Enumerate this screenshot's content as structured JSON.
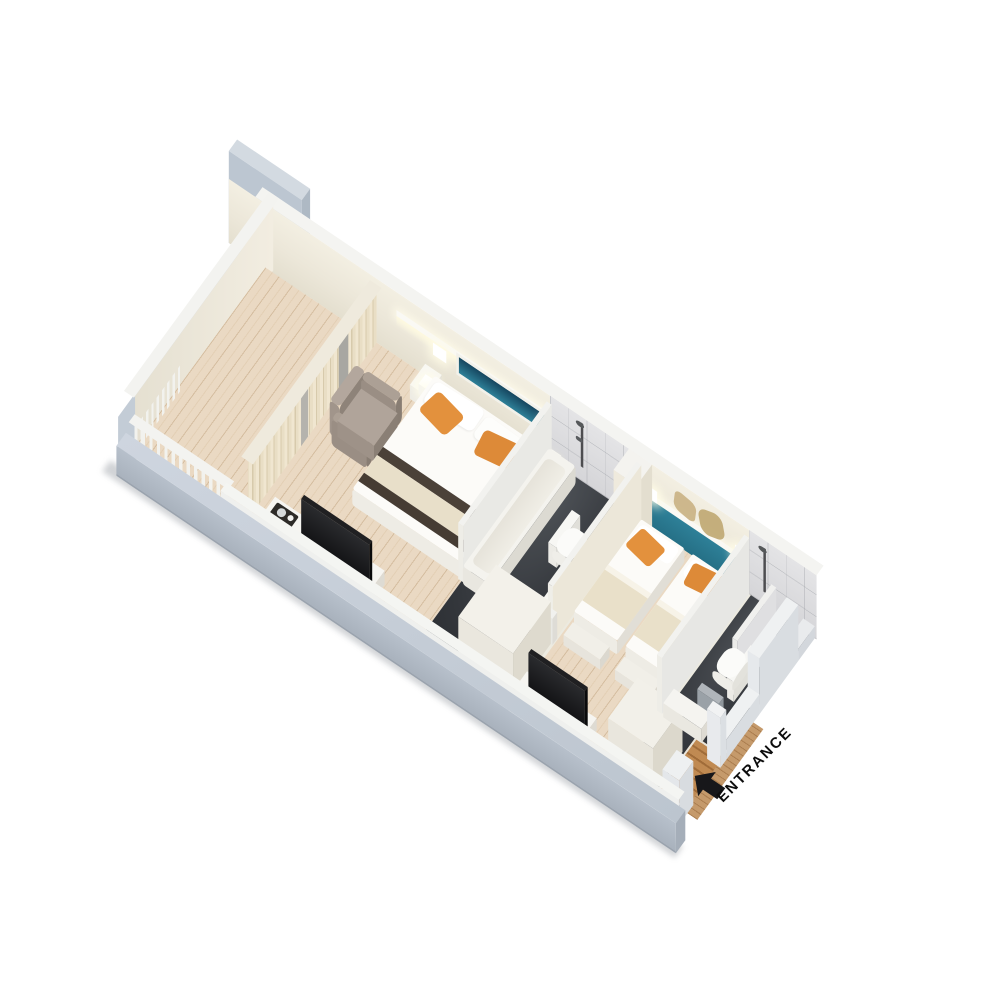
{
  "entrance": {
    "label": "ENTRANCE"
  },
  "colors": {
    "accent_teal": "#2e8098",
    "teal_dark": "#16465f",
    "pillow_orange": "#e3913d",
    "pillow_orange_2": "#dd8a38",
    "floor_wood": "#ead9c3",
    "floor_dark": "#34373c",
    "wall_cream": "#ece7d9",
    "wall_outer_gray": "#c2cbd5",
    "marble_gray": "#dcdcde",
    "entrance_wood": "#c08a52",
    "label_black": "#0d0d0d"
  }
}
